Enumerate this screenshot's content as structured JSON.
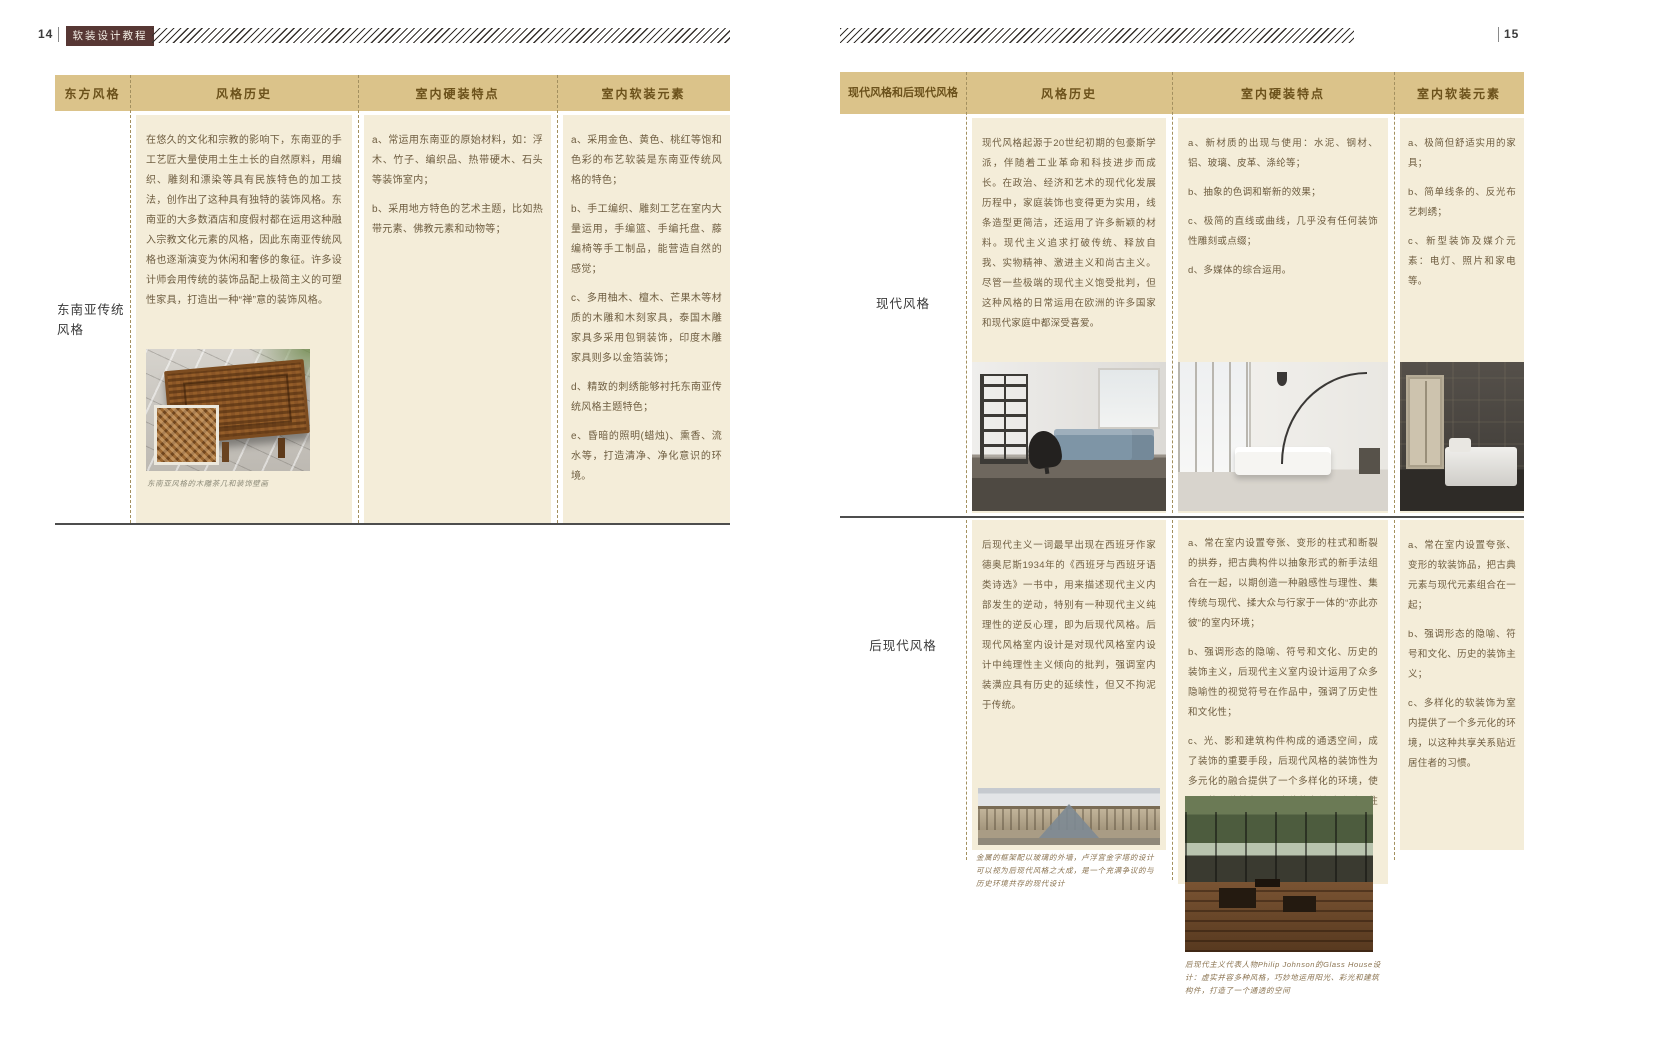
{
  "colors": {
    "header_bg": "#dbc38a",
    "cell_bg": "#f4edd9",
    "badge_bg": "#573734",
    "body_text": "#6e5d40",
    "header_text": "#6b511b"
  },
  "left_page": {
    "page_number": "14",
    "book_title": "软装设计教程",
    "table": {
      "headers": [
        "东方风格",
        "风格历史",
        "室内硬装特点",
        "室内软装元素"
      ],
      "row_label": "东南亚传统风格",
      "history": "在悠久的文化和宗教的影响下，东南亚的手工艺匠大量使用土生土长的自然原料，用编织、雕刻和漂染等具有民族特色的加工技法，创作出了这种具有独特的装饰风格。东南亚的大多数酒店和度假村都在运用这种融入宗教文化元素的风格，因此东南亚传统风格也逐渐演变为休闲和奢侈的象征。许多设计师会用传统的装饰品配上极简主义的可塑性家具，打造出一种“禅”意的装饰风格。",
      "hardscape": [
        "a、常运用东南亚的原始材料，如：浮木、竹子、编织品、热带硬木、石头等装饰室内；",
        "b、采用地方特色的艺术主题，比如热带元素、佛教元素和动物等；"
      ],
      "softscape": [
        "a、采用金色、黄色、桃红等饱和色彩的布艺软装是东南亚传统风格的特色；",
        "b、手工编织、雕刻工艺在室内大量运用，手编篮、手编托盘、藤编椅等手工制品，能营造自然的感觉；",
        "c、多用柚木、檀木、芒果木等材质的木雕和木刻家具，泰国木雕家具多采用包铜装饰，印度木雕家具则多以金箔装饰；",
        "d、精致的刺绣能够衬托东南亚传统风格主题特色；",
        "e、昏暗的照明(蜡烛)、熏香、流水等，打造清净、净化意识的环境。"
      ],
      "photo_caption": "东南亚风格的木雕茶几和装饰壁画"
    }
  },
  "right_page": {
    "page_number": "15",
    "table": {
      "headers": [
        "现代风格和后现代风格",
        "风格历史",
        "室内硬装特点",
        "室内软装元素"
      ],
      "rows": [
        {
          "label": "现代风格",
          "history": "现代风格起源于20世纪初期的包豪斯学派，伴随着工业革命和科技进步而成长。在政治、经济和艺术的现代化发展历程中，家庭装饰也变得更为实用，线条造型更简洁，还运用了许多新颖的材料。现代主义追求打破传统、释放自我、实物精神、激进主义和尚古主义。尽管一些极端的现代主义饱受批判，但这种风格的日常运用在欧洲的许多国家和现代家庭中都深受喜爱。",
          "hardscape": [
            "a、新材质的出现与使用：水泥、钢材、铝、玻璃、皮革、涤纶等；",
            "b、抽象的色调和崭新的效果；",
            "c、极简的直线或曲线，几乎没有任何装饰性雕刻或点缀；",
            "d、多媒体的综合运用。"
          ],
          "softscape": [
            "a、极简但舒适实用的家具；",
            "b、简单线条的、反光布艺刺绣；",
            "c、新型装饰及媒介元素：电灯、照片和家电等。"
          ]
        },
        {
          "label": "后现代风格",
          "history": "后现代主义一词最早出现在西班牙作家德奥尼斯1934年的《西班牙与西班牙语类诗选》一书中，用来描述现代主义内部发生的逆动，特别有一种现代主义纯理性的逆反心理，即为后现代风格。后现代风格室内设计是对现代风格室内设计中纯理性主义倾向的批判，强调室内装潢应具有历史的延续性，但又不拘泥于传统。",
          "hardscape": [
            "a、常在室内设置夸张、变形的柱式和断裂的拱券，把古典构件以抽象形式的新手法组合在一起，以期创造一种融感性与理性、集传统与现代、揉大众与行家于一体的“亦此亦彼”的室内环境；",
            "b、强调形态的隐喻、符号和文化、历史的装饰主义，后现代主义室内设计运用了众多隐喻性的视觉符号在作品中，强调了历史性和文化性；",
            "c、光、影和建筑构件构成的通透空间，成了装饰的重要手段，后现代风格的装饰性为多元化的融合提供了一个多样化的环境，使不同的风貌并存，以这种共享关系贴近居住者的习惯。"
          ],
          "softscape": [
            "a、常在室内设置夸张、变形的软装饰品，把古典元素与现代元素组合在一起；",
            "b、强调形态的隐喻、符号和文化、历史的装饰主义；",
            "c、多样化的软装饰为室内提供了一个多元化的环境，以这种共享关系贴近居住者的习惯。"
          ],
          "photo_caption_louvre": "金属的框架配以玻璃的外墙，卢浮宫金字塔的设计可以视为后现代风格之大成，是一个充满争议的与历史环境共存的现代设计",
          "photo_caption_glasshouse": "后现代主义代表人物Philip Johnson的Glass House设计：虚实并容多种风格，巧妙地运用阳光、彩光和建筑构件，打造了一个通透的空间"
        }
      ]
    }
  }
}
